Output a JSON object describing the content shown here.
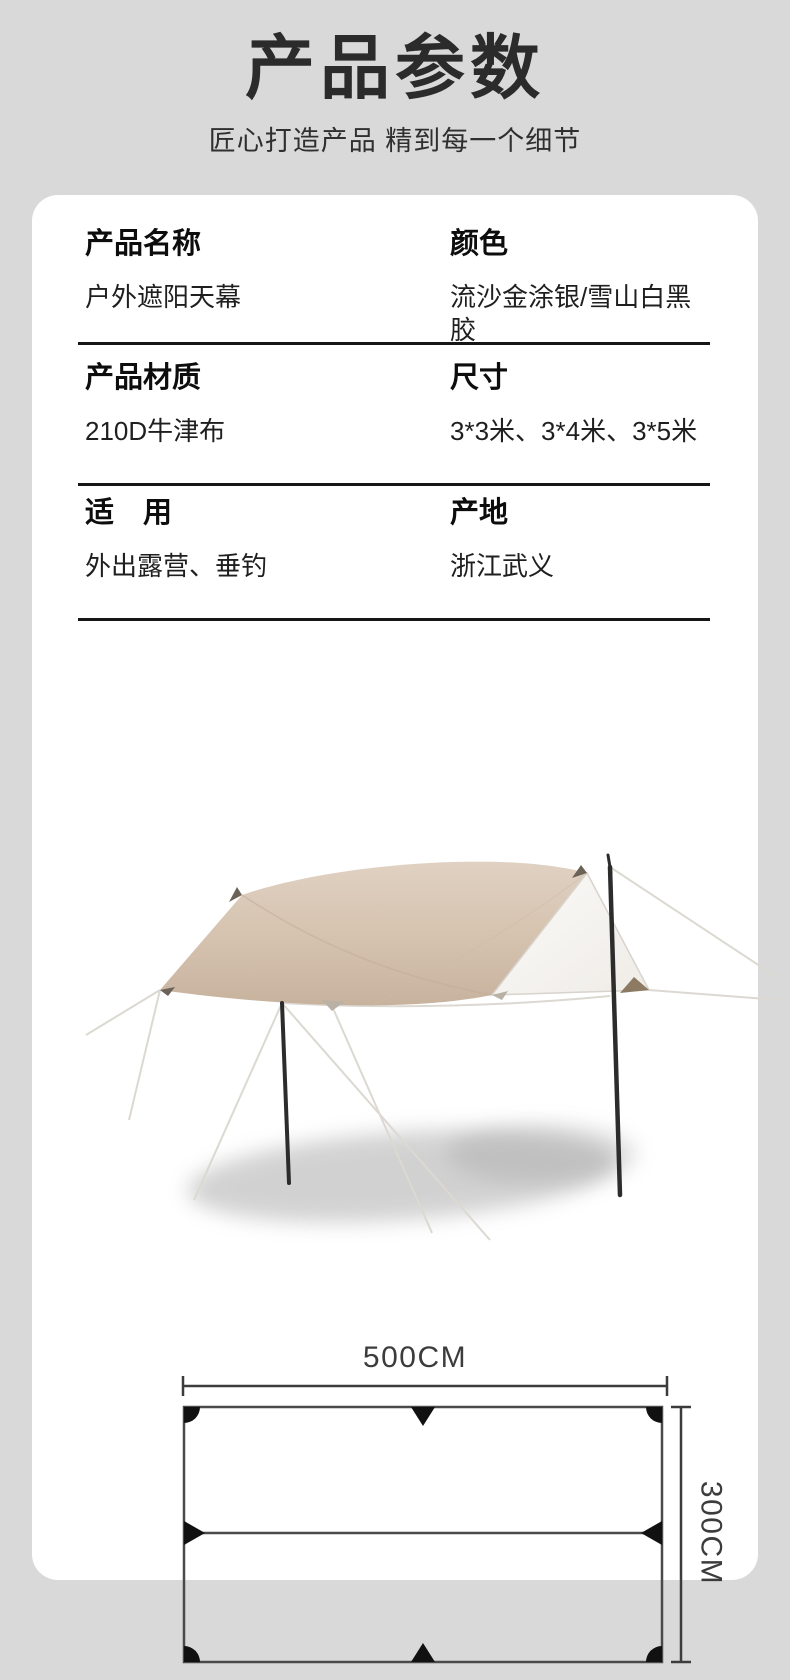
{
  "colors": {
    "page_background": "#d9d9d9",
    "card_background": "#ffffff",
    "divider": "#161616",
    "tarp_beige_top": "#decebf",
    "tarp_beige_bottom": "#c7b29e",
    "pole_dark": "#2c2c2c",
    "diagram_line": "#4a4a4a",
    "diagram_marker": "#111111"
  },
  "header": {
    "title": "产品参数",
    "subtitle": "匠心打造产品 精到每一个细节"
  },
  "specs": {
    "rows": [
      {
        "left": {
          "label": "产品名称",
          "value": "户外遮阳天幕"
        },
        "right": {
          "label": "颜色",
          "value": "流沙金涂银/雪山白黑胶"
        }
      },
      {
        "left": {
          "label": "产品材质",
          "value": "210D牛津布"
        },
        "right": {
          "label": "尺寸",
          "value": "3*3米、3*4米、3*5米"
        }
      },
      {
        "left": {
          "label": "适　用",
          "value": "外出露营、垂钓"
        },
        "right": {
          "label": "产地",
          "value": "浙江武义"
        }
      }
    ]
  },
  "diagram": {
    "width_label": "500CM",
    "height_label": "300CM"
  }
}
